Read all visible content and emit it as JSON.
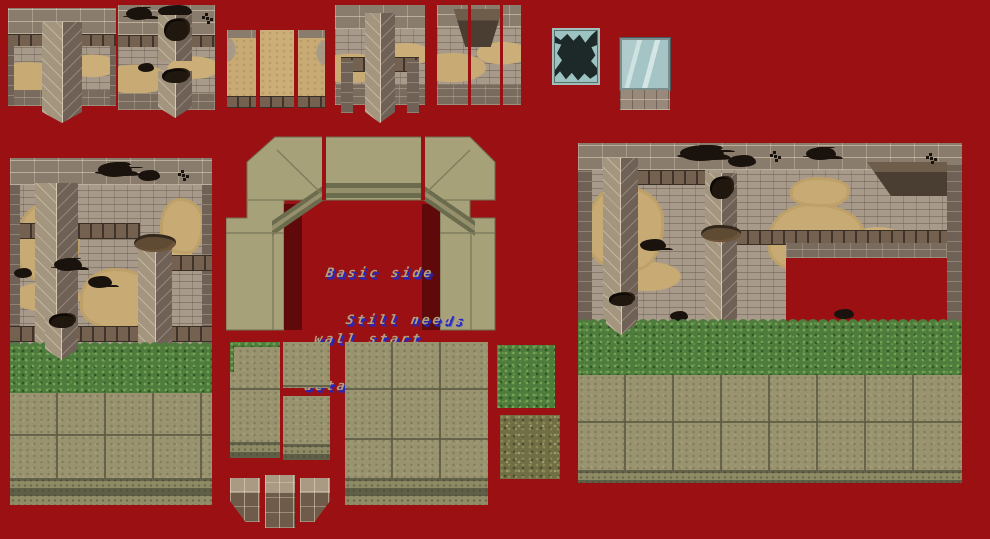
{
  "sheet": {
    "description": "Pixel-art stone-ruins game tileset sprite sheet on a red transparency background",
    "notes": {
      "line1": "Basic side",
      "line2": "wall start",
      "line3": "Still needs",
      "line4": "details"
    },
    "colors": {
      "background": "#9B1013",
      "shadow_red": "#5F090B",
      "wall_brick": "#8A7C6C",
      "mortar": "#E2D5BF",
      "rubble": "#A79A8A",
      "sand": "#C7AA74",
      "ledge_dark": "#54463A",
      "pillar_light": "#A3957E",
      "pillar_dark": "#6F6156",
      "arch_flat": "#A7A17A",
      "molding_dark": "#6B6B4D",
      "molding_light": "#93906B",
      "grass_green": "#4E7C3C",
      "grass_dry": "#6F6E44",
      "floor_khaki": "#99936F",
      "floor_line": "#5C5C44",
      "glass_blue": "#A5C4C6",
      "broken_glass_dark": "#1D2928",
      "note_text": "#B1A07E",
      "note_shadow_blue": "#2228C4"
    },
    "tiles": [
      {
        "name": "wall-pillar-straight",
        "description": "Stone wall with central square pillar, pointed base"
      },
      {
        "name": "wall-damaged",
        "description": "Stone wall with black holes, broken pillar stub"
      },
      {
        "name": "sand-wall-strips",
        "description": "Three narrow sand-buried wall segments"
      },
      {
        "name": "wall-column-corner",
        "description": "Wall with corner column and side posts"
      },
      {
        "name": "wall-niche",
        "description": "Wall with recessed niche, three column guides"
      },
      {
        "name": "window-broken",
        "description": "Broken window with glass shards"
      },
      {
        "name": "window-glass",
        "description": "Intact glass window with stone sill"
      },
      {
        "name": "ruin-wall-large-left",
        "description": "Large ruined wall scene with pillars, sand, grass and floor"
      },
      {
        "name": "arch-doorway-wip",
        "description": "Flat untextured side-wall doorway arch, work in progress"
      },
      {
        "name": "floor-edge-grass",
        "description": "Small floor tile with grass fringe"
      },
      {
        "name": "floor-piece-top",
        "description": "Small plain floor tile"
      },
      {
        "name": "floor-piece-bottom",
        "description": "Small floor tile with base trim"
      },
      {
        "name": "floor-large-3x3",
        "description": "Large 3x3 stone floor tile with base trim"
      },
      {
        "name": "grass-tile",
        "description": "Green grass texture tile"
      },
      {
        "name": "dry-grass-tile",
        "description": "Dry olive grass texture tile"
      },
      {
        "name": "doorway-underside",
        "description": "Doorway top underside piece, three segments"
      },
      {
        "name": "ruin-wall-large-right",
        "description": "Large ruined wall scene with cut-out opening, grass and floor"
      }
    ]
  }
}
